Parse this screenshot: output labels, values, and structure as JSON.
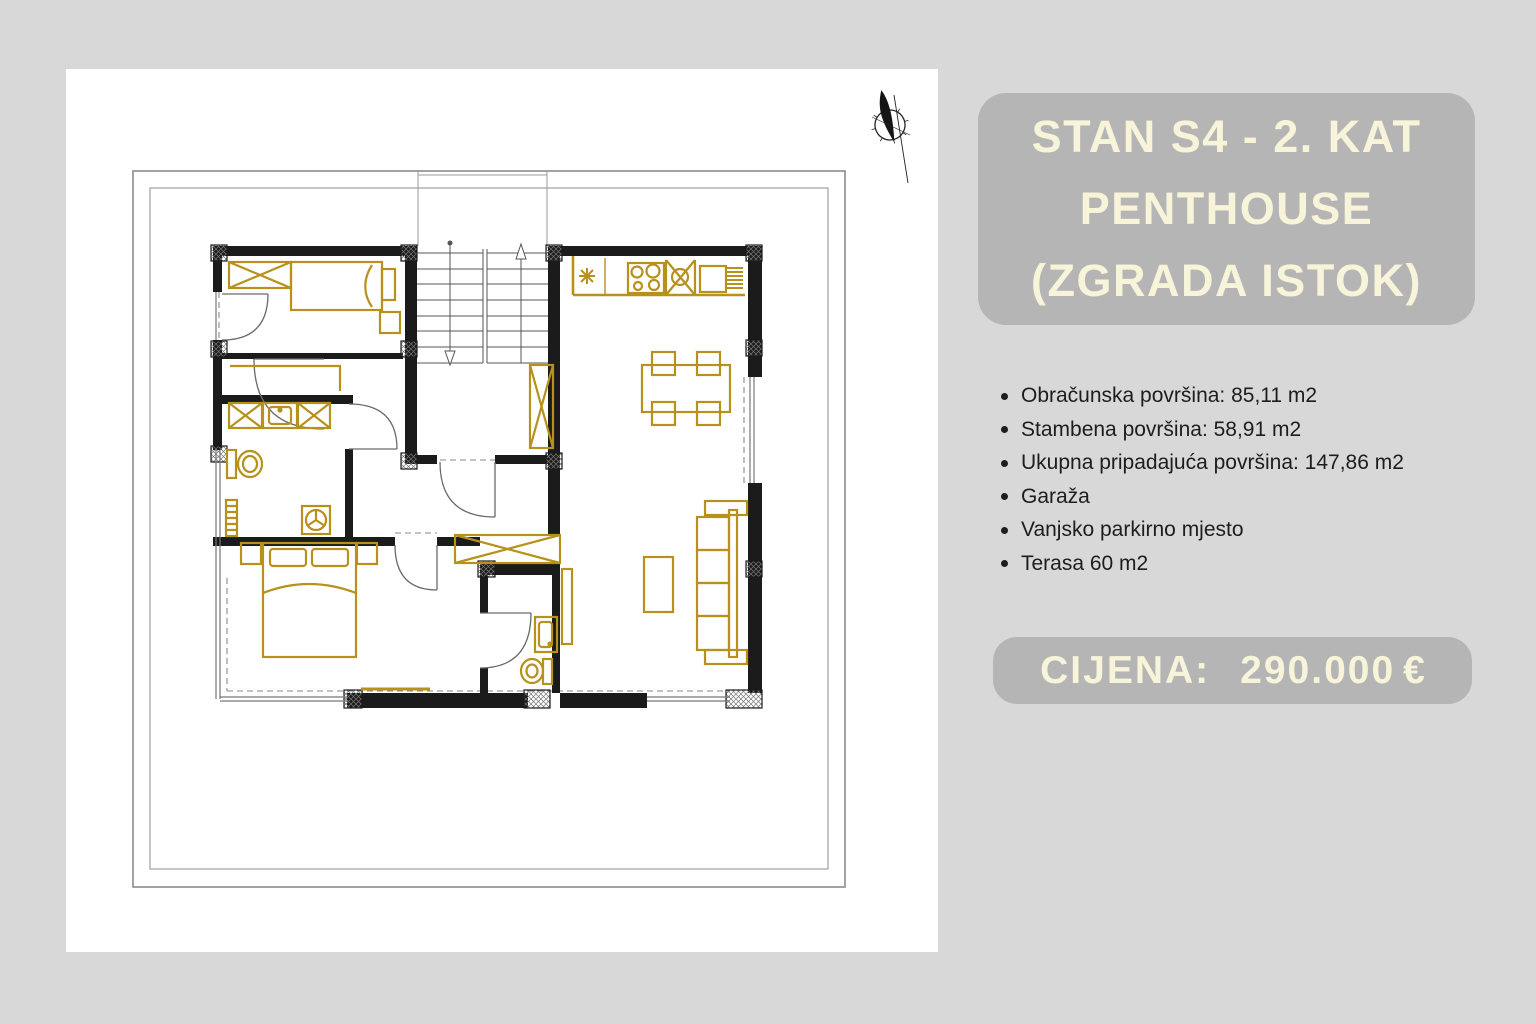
{
  "colors": {
    "background": "#d8d8d8",
    "panel": "#ffffff",
    "box_gray": "#b5b5b5",
    "cream_text": "#f7f4da",
    "body_text": "#1d1d1d",
    "plan_gold": "#b8901c",
    "plan_wall": "#1b1b1b"
  },
  "floor_plan": {
    "description": "apartment floor plan drawing",
    "compass_icon": "north-compass"
  },
  "listing": {
    "title_lines": {
      "0": "STAN S4 - 2. KAT",
      "1": "PENTHOUSE",
      "2": "(ZGRADA ISTOK)"
    },
    "features": {
      "0": "Obračunska površina: 85,11 m2",
      "1": "Stambena površina: 58,91 m2",
      "2": "Ukupna pripadajuća površina: 147,86 m2",
      "3": "Garaža",
      "4": "Vanjsko parkirno mjesto",
      "5": "Terasa 60 m2"
    },
    "price": {
      "label": "CIJENA:",
      "value": "290.000",
      "currency": "€"
    }
  }
}
